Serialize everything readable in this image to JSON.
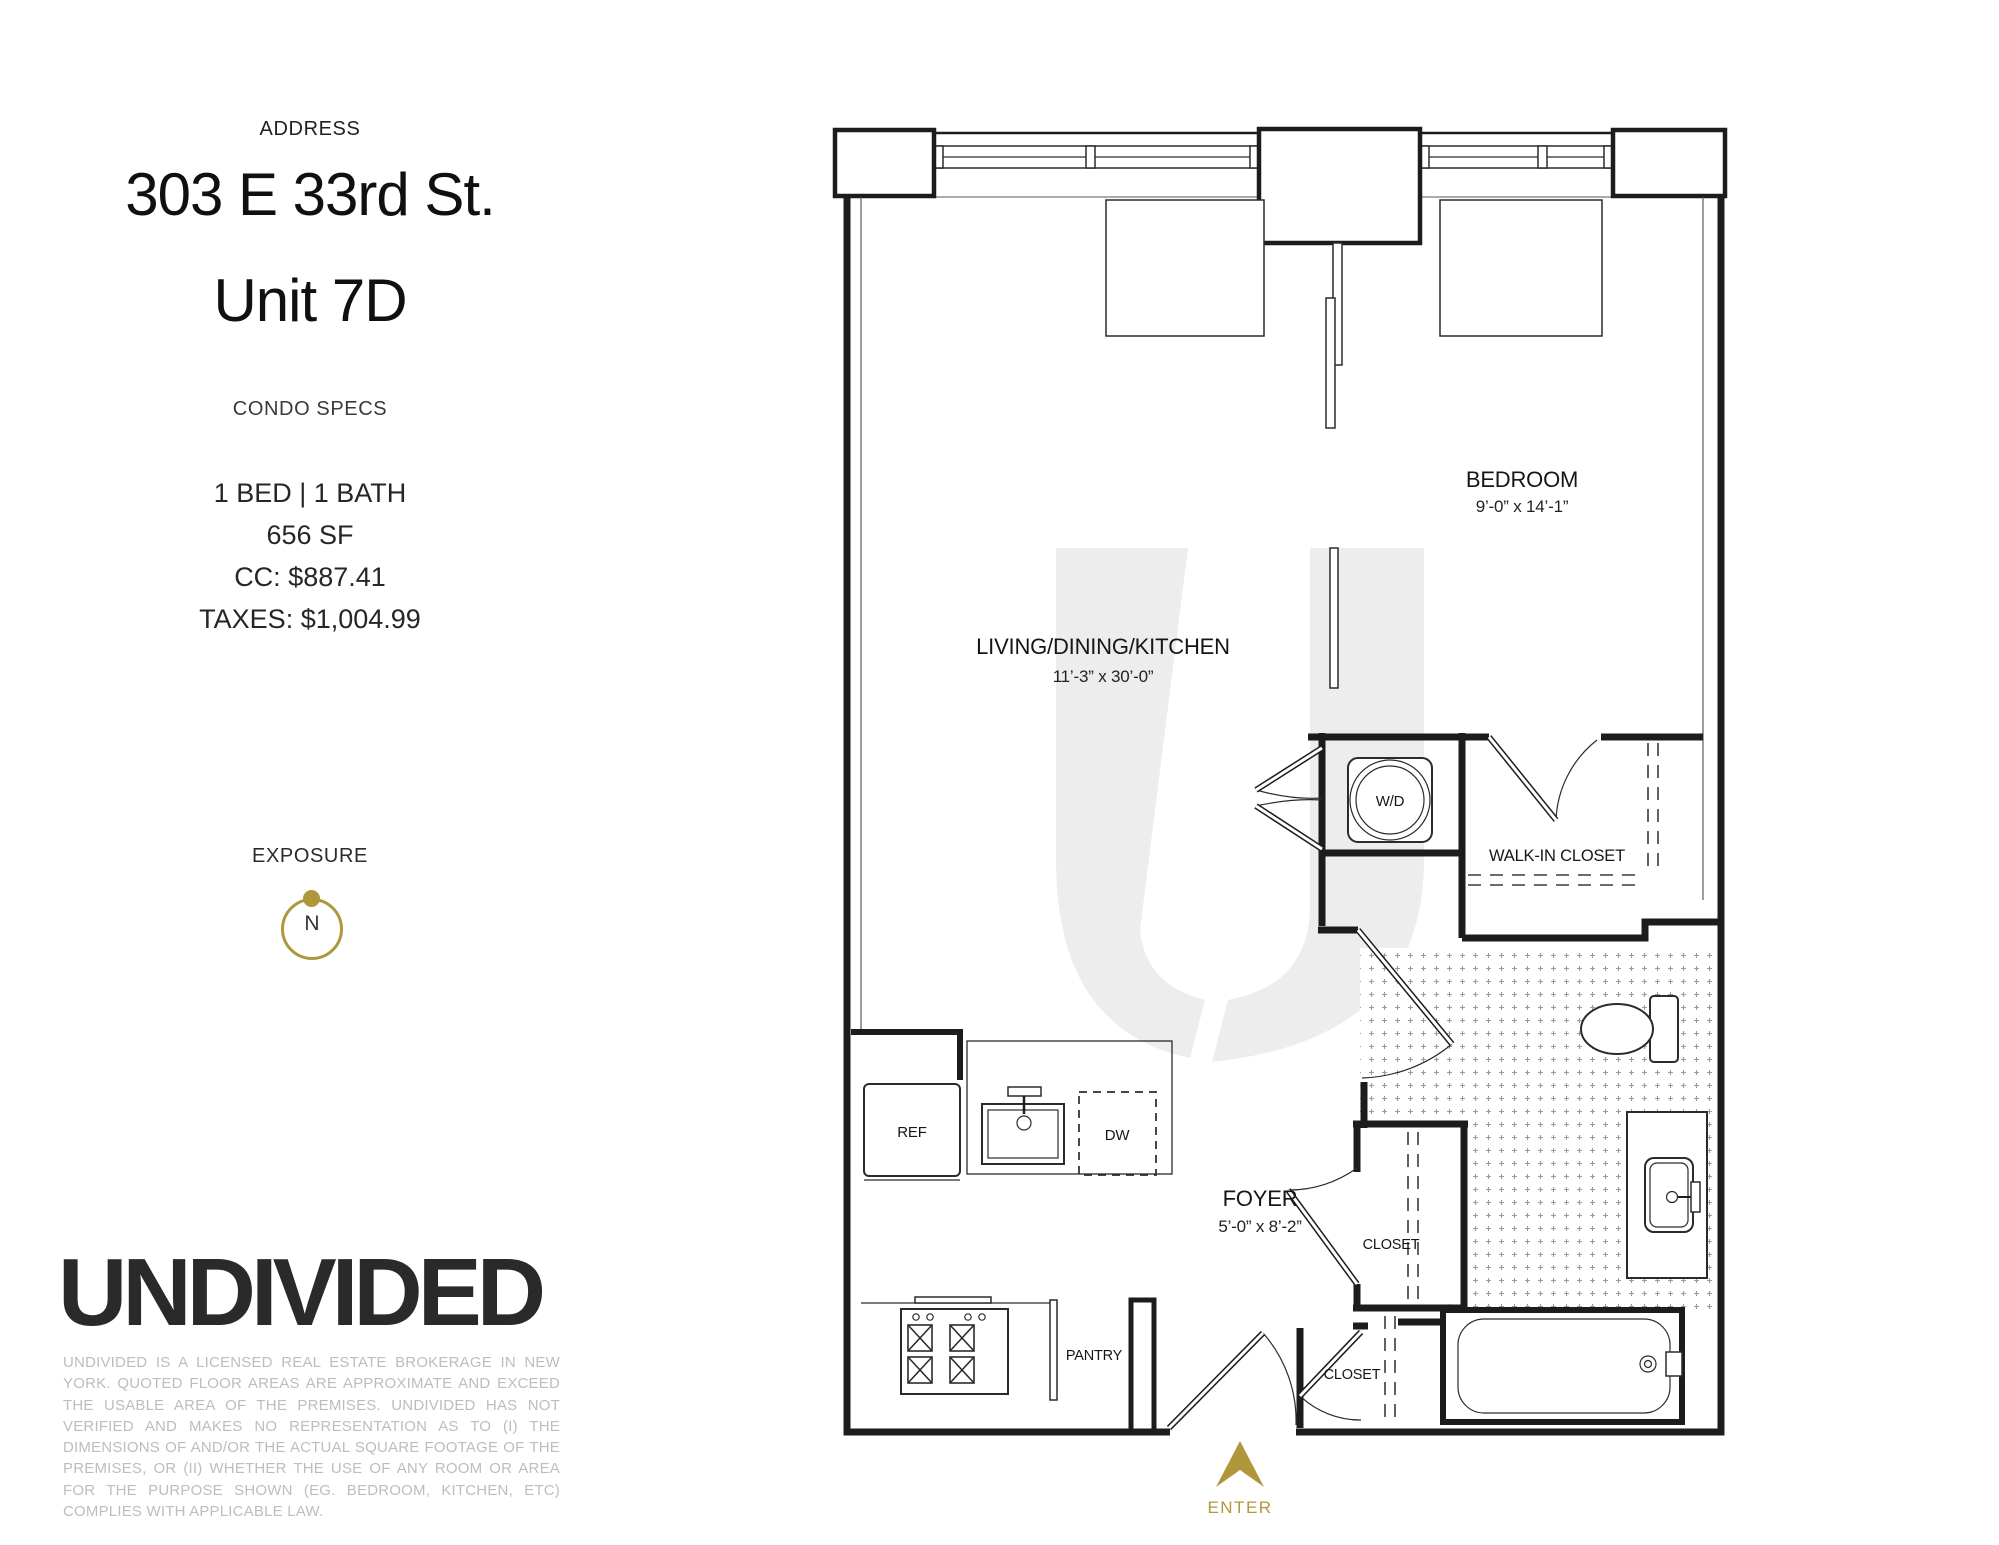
{
  "info_panel": {
    "address_label": "ADDRESS",
    "address_line1": "303 E 33rd St.",
    "address_line2": "Unit 7D",
    "specs_label": "CONDO SPECS",
    "specs": [
      "1 BED | 1 BATH",
      "656 SF",
      "CC: $887.41",
      "TAXES: $1,004.99"
    ],
    "exposure_label": "EXPOSURE",
    "exposure_direction": "N"
  },
  "brand": {
    "logo_text": "UNDIVIDED",
    "disclaimer": "UNDIVIDED IS A LICENSED REAL ESTATE BROKERAGE IN NEW YORK. QUOTED FLOOR AREAS ARE APPROXIMATE AND EXCEED THE USABLE AREA OF THE PREMISES. UNDIVIDED HAS NOT VERIFIED AND MAKES NO REPRESENTATION AS TO (I) THE DIMENSIONS OF AND/OR THE ACTUAL SQUARE FOOTAGE OF THE PREMISES, OR (II) WHETHER THE USE OF ANY ROOM OR AREA FOR THE PURPOSE SHOWN (EG. BEDROOM, KITCHEN, ETC) COMPLIES WITH APPLICABLE LAW."
  },
  "floor_plan": {
    "rooms": {
      "bedroom": {
        "name": "BEDROOM",
        "dims": "9’-0” x 14’-1”"
      },
      "living": {
        "name": "LIVING/DINING/KITCHEN",
        "dims": "11’-3” x 30’-0”"
      },
      "foyer": {
        "name": "FOYER",
        "dims": "5’-0” x 8’-2”"
      },
      "walk_in_closet": {
        "name": "WALK-IN CLOSET"
      },
      "foyer_closet": {
        "name": "CLOSET"
      },
      "entry_closet": {
        "name": "CLOSET"
      },
      "pantry": {
        "name": "PANTRY"
      }
    },
    "fixtures": {
      "washer_dryer": "W/D",
      "refrigerator": "REF",
      "dishwasher": "DW"
    },
    "entry_label": "ENTER"
  },
  "colors": {
    "accent_gold": "#b0973c",
    "wall": "#1c1c1c",
    "watermark": "#ededed"
  }
}
